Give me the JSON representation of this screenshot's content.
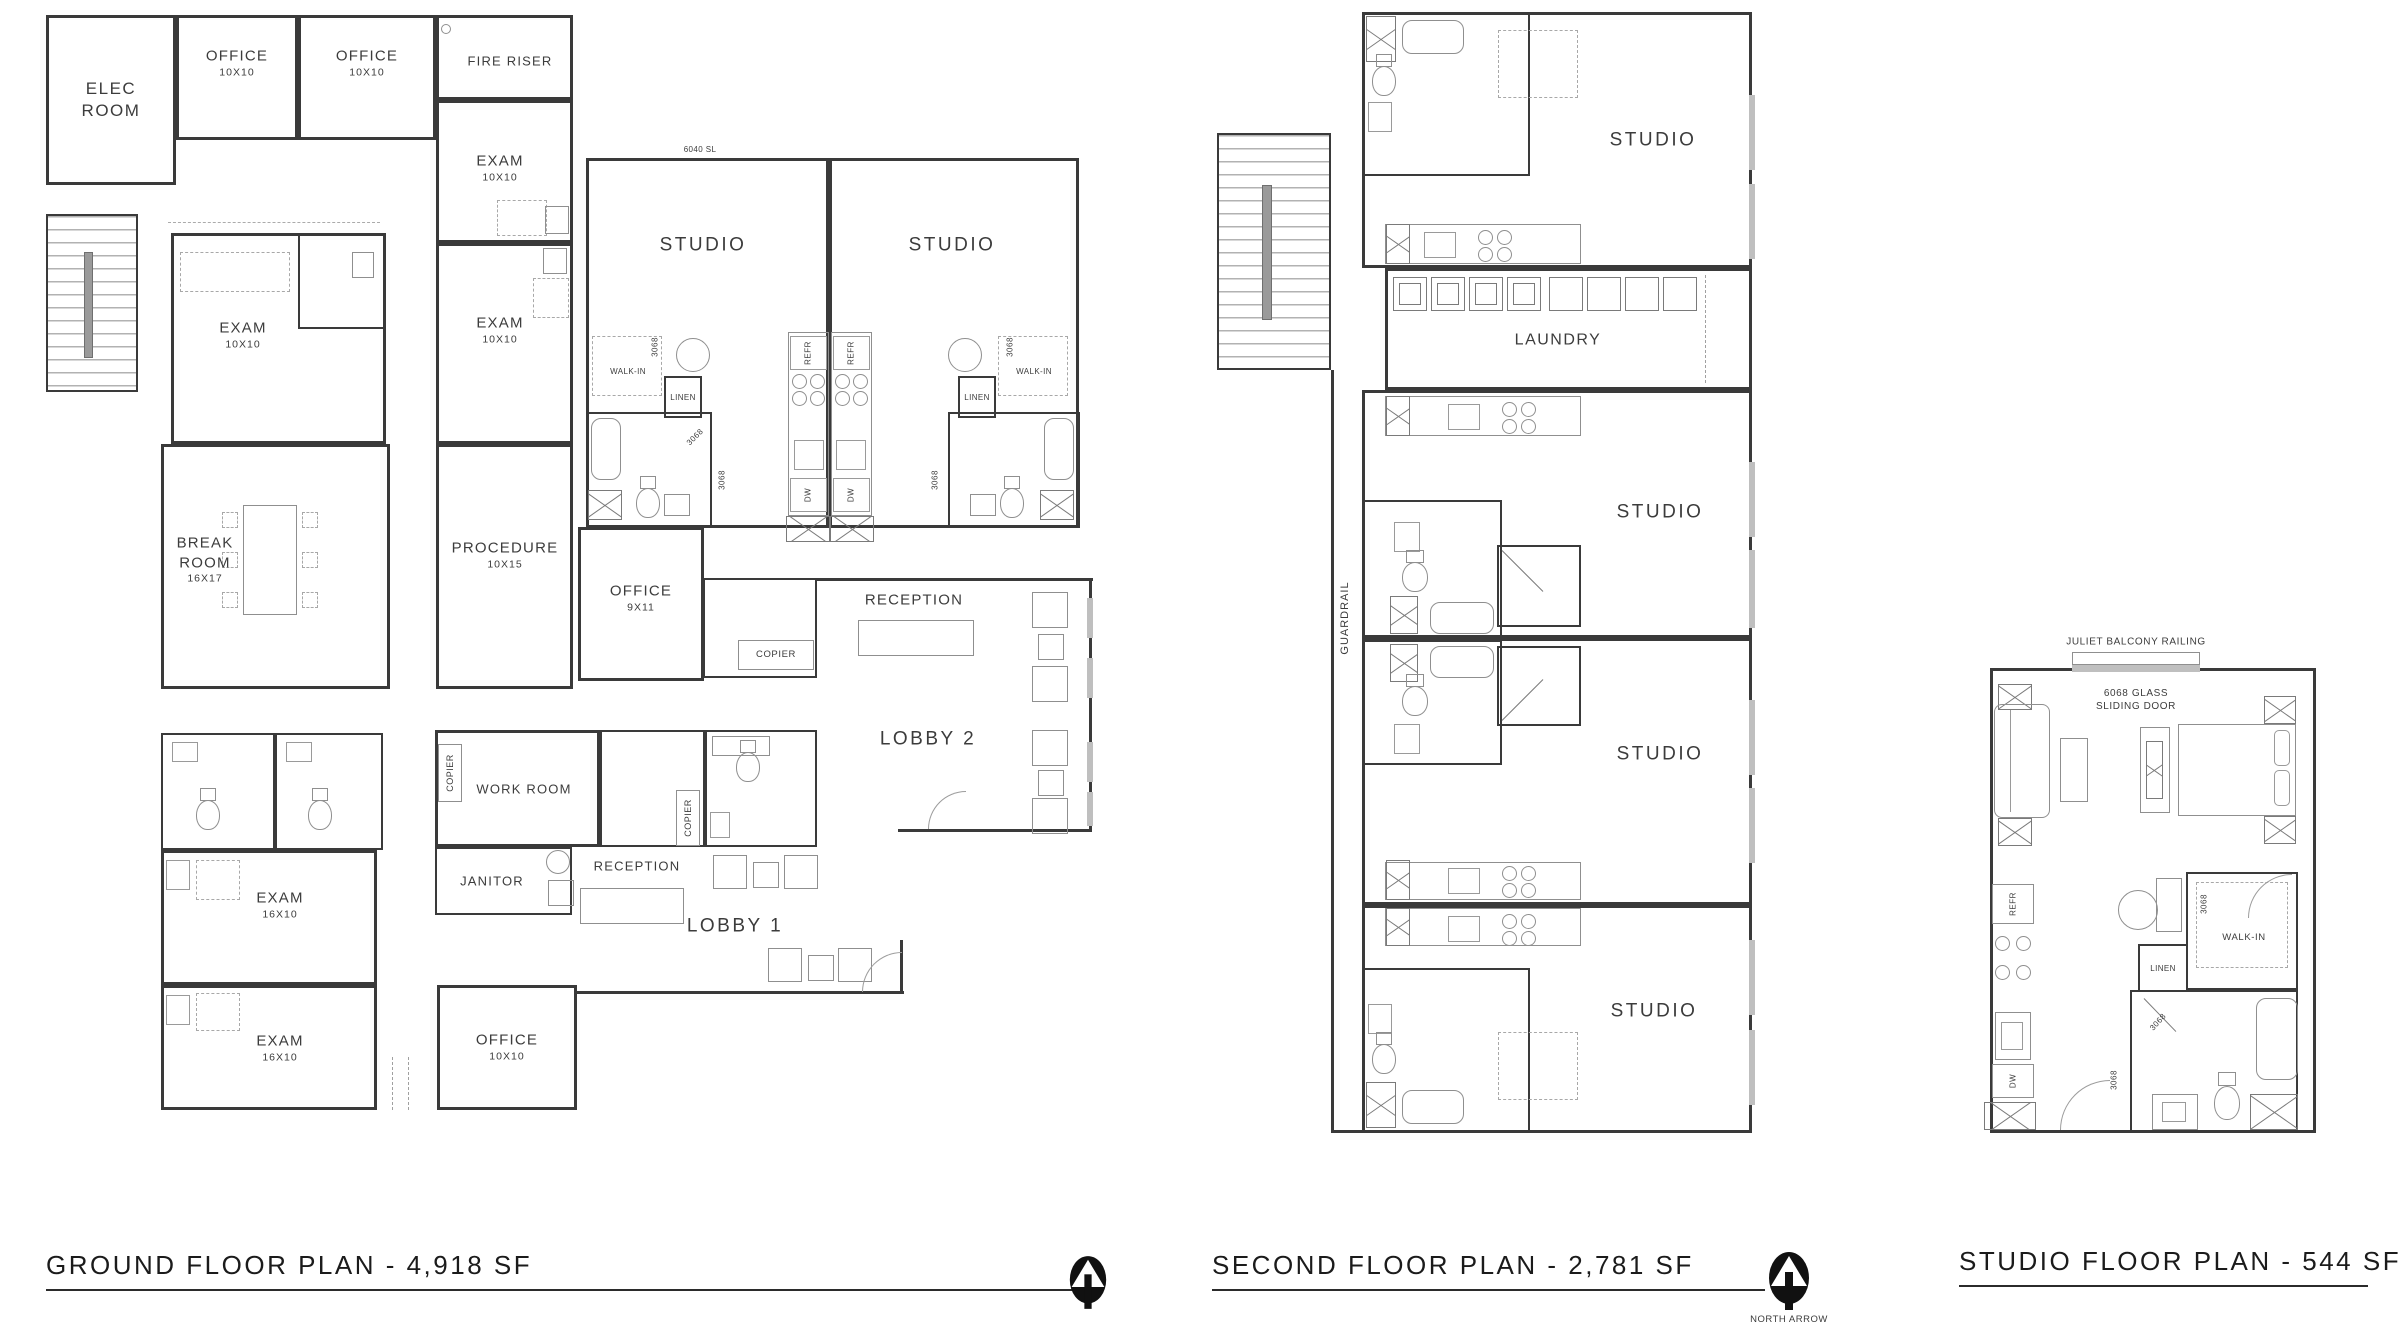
{
  "sheet": {
    "background": "#ffffff",
    "wall_color": "#3a3a3a",
    "fixture_color": "#8f8f8f",
    "title_color": "#1b1b1b"
  },
  "titles": {
    "ground": "GROUND FLOOR PLAN - 4,918 SF",
    "second": "SECOND FLOOR PLAN - 2,781 SF",
    "studio": "STUDIO FLOOR PLAN - 544 SF",
    "north_arrow_caption": "NORTH ARROW"
  },
  "labels": {
    "elec_room": "ELEC ROOM",
    "office": "OFFICE",
    "exam": "EXAM",
    "fire_riser": "FIRE RISER",
    "break_room": "BREAK ROOM",
    "procedure": "PROCEDURE",
    "studio": "STUDIO",
    "reception": "RECEPTION",
    "copier": "COPIER",
    "lobby1": "LOBBY 1",
    "lobby2": "LOBBY 2",
    "work_room": "WORK ROOM",
    "janitor": "JANITOR",
    "laundry": "LAUNDRY",
    "guardrail": "GUARDRAIL",
    "walk_in": "WALK-IN",
    "linen": "LINEN",
    "refr": "REFR",
    "dw": "DW",
    "size_10x10": "10X10",
    "size_16x10": "16X10",
    "size_16x17": "16X17",
    "size_10x15": "10X15",
    "size_9x11": "9X11",
    "door_3068": "3068",
    "window_6040": "6040 SL",
    "juliet_railing": "JULIET BALCONY RAILING",
    "sliding_door_line1": "6068 GLASS",
    "sliding_door_line2": "SLIDING DOOR"
  }
}
